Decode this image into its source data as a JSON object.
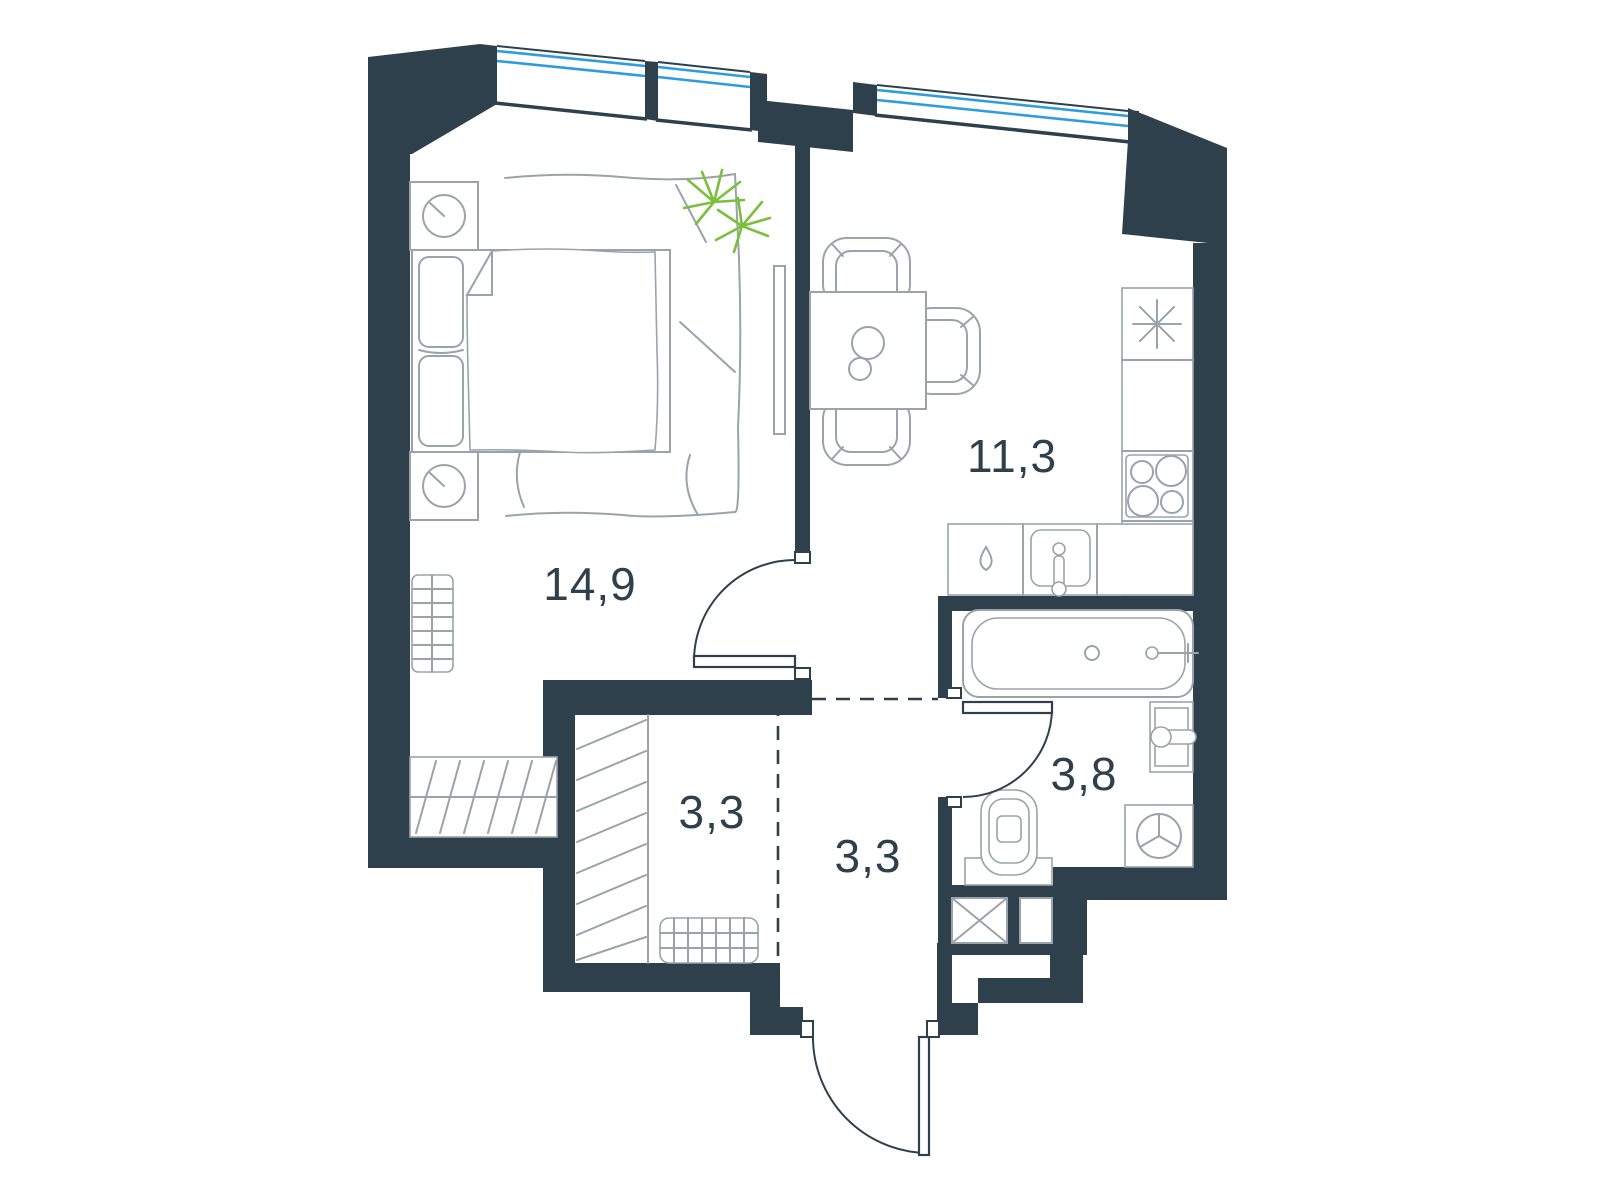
{
  "title": "Apartment floor plan",
  "rooms": [
    {
      "id": "bedroom",
      "area": "14,9"
    },
    {
      "id": "kitchen_living",
      "area": "11,3"
    },
    {
      "id": "wardrobe",
      "area": "3,3"
    },
    {
      "id": "hallway",
      "area": "3,3"
    },
    {
      "id": "bathroom",
      "area": "3,8"
    }
  ],
  "fixtures": {
    "bedroom": [
      "double-bed",
      "pillows",
      "duvet",
      "rug",
      "nightstand-lamp",
      "nightstand-lamp",
      "radiator",
      "floor-mat",
      "plant",
      "tv"
    ],
    "kitchen": [
      "dining-table",
      "chair",
      "chair",
      "chair",
      "table-decor",
      "fridge-snowflake",
      "tall-cabinet",
      "stove-4-burners",
      "counter",
      "dishwasher-drop",
      "sink-with-tap"
    ],
    "bathroom": [
      "bathtub",
      "wall-basin",
      "toilet",
      "washing-machine",
      "shaft-cross",
      "shaft"
    ],
    "wardrobe": [
      "clothes-rail-hatch",
      "shoe-rack-grid"
    ]
  },
  "openings": {
    "windows": 3,
    "interior_doors": 2,
    "entrance_doors": 1
  },
  "colors": {
    "wall": "#2e404b",
    "line": "#9aa3ab",
    "glass": "#2f9ce0",
    "plant": "#7cbf3f",
    "text": "#2e404b",
    "bg": "#ffffff"
  }
}
